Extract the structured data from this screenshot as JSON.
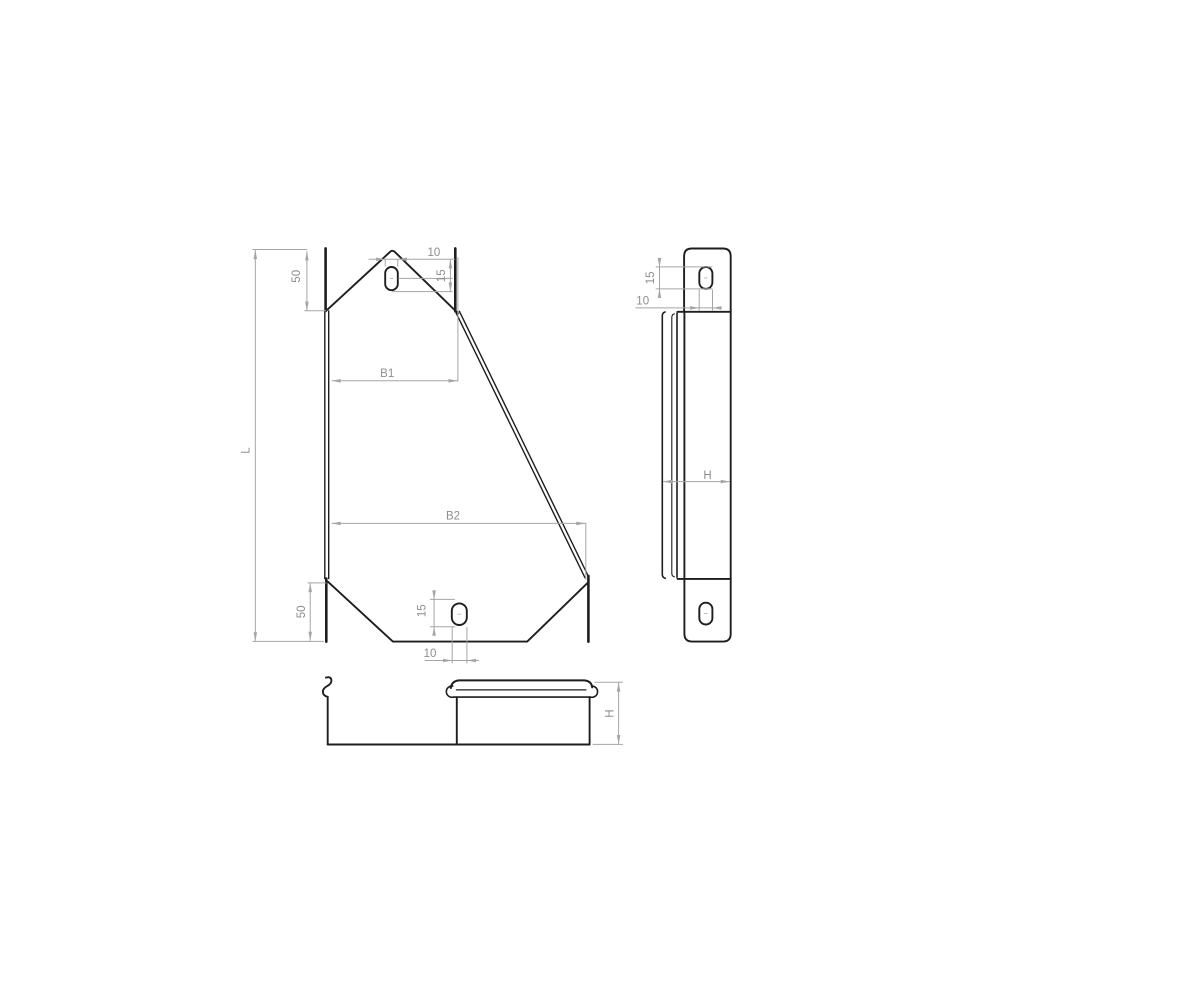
{
  "meta": {
    "background": "#ffffff",
    "part_line_color": "#1e1e1e",
    "dim_line_color": "#a5a5a5",
    "dim_text_color": "#8d8d8d",
    "drawing_type": "technical-drawing-cable-tray-reducer-3-views"
  },
  "front_view": {
    "label_length": "L",
    "label_top_tab": "50",
    "label_bottom_tab": "50",
    "label_width_top": "B1",
    "label_width_bottom": "B2",
    "top_slot": {
      "width": "10",
      "height": "15"
    },
    "bottom_slot": {
      "width": "10",
      "height": "15"
    }
  },
  "side_view": {
    "slot": {
      "width": "10",
      "height": "15"
    },
    "label_depth": "H"
  },
  "bottom_view": {
    "label_height": "H"
  }
}
